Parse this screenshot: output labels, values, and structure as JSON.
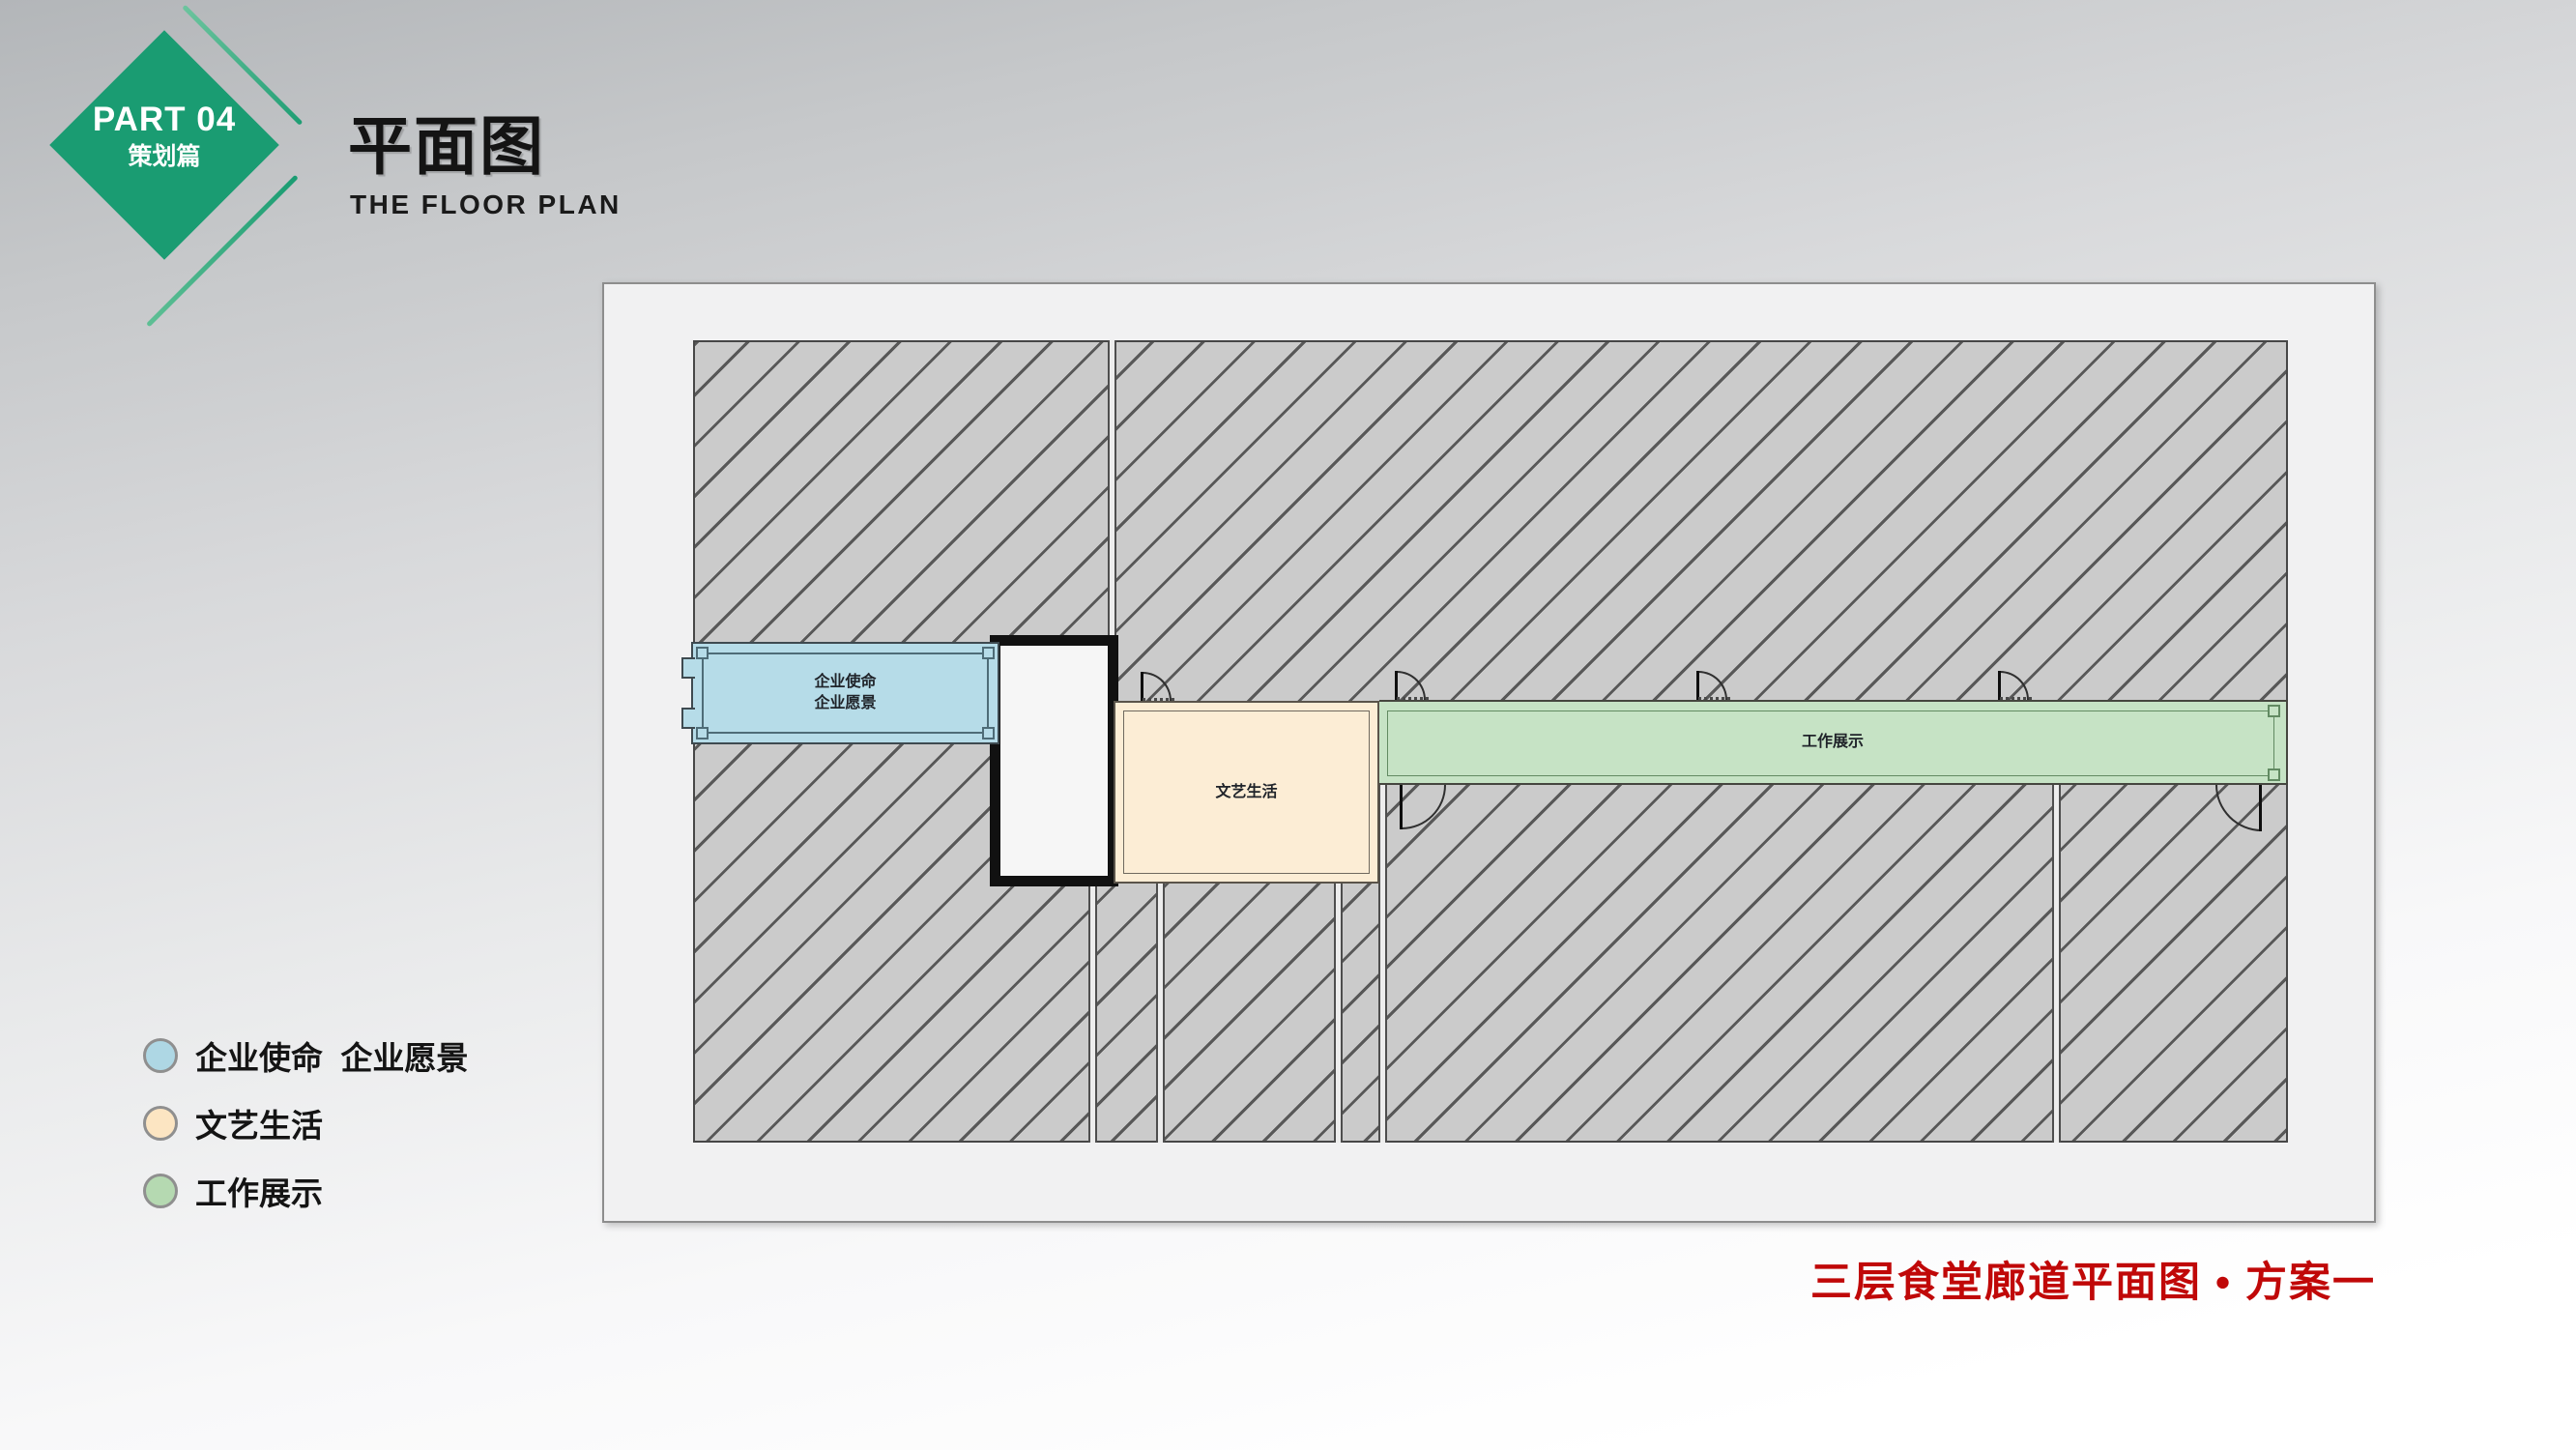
{
  "badge": {
    "part_label": "PART 04",
    "section_label": "策划篇",
    "diamond_color": "#1a9c72"
  },
  "header": {
    "title": "平面图",
    "subtitle": "THE FLOOR PLAN"
  },
  "plan": {
    "wall_fill": "#cbcbcb",
    "wall_line": "#585858",
    "rooms": {
      "mission": {
        "line1": "企业使命",
        "line2": "企业愿景",
        "fill": "#b6dce8"
      },
      "art": {
        "label": "文艺生活",
        "fill": "#fcedd5"
      },
      "work": {
        "label": "工作展示",
        "fill": "#c6e3c5"
      }
    }
  },
  "legend": {
    "items": [
      {
        "label": "企业使命  企业愿景",
        "swatch": "#aed7e4"
      },
      {
        "label": "文艺生活",
        "swatch": "#fce5c2"
      },
      {
        "label": "工作展示",
        "swatch": "#b5d9b1"
      }
    ]
  },
  "caption": {
    "text": "三层食堂廊道平面图 • 方案一",
    "color": "#c00808"
  }
}
